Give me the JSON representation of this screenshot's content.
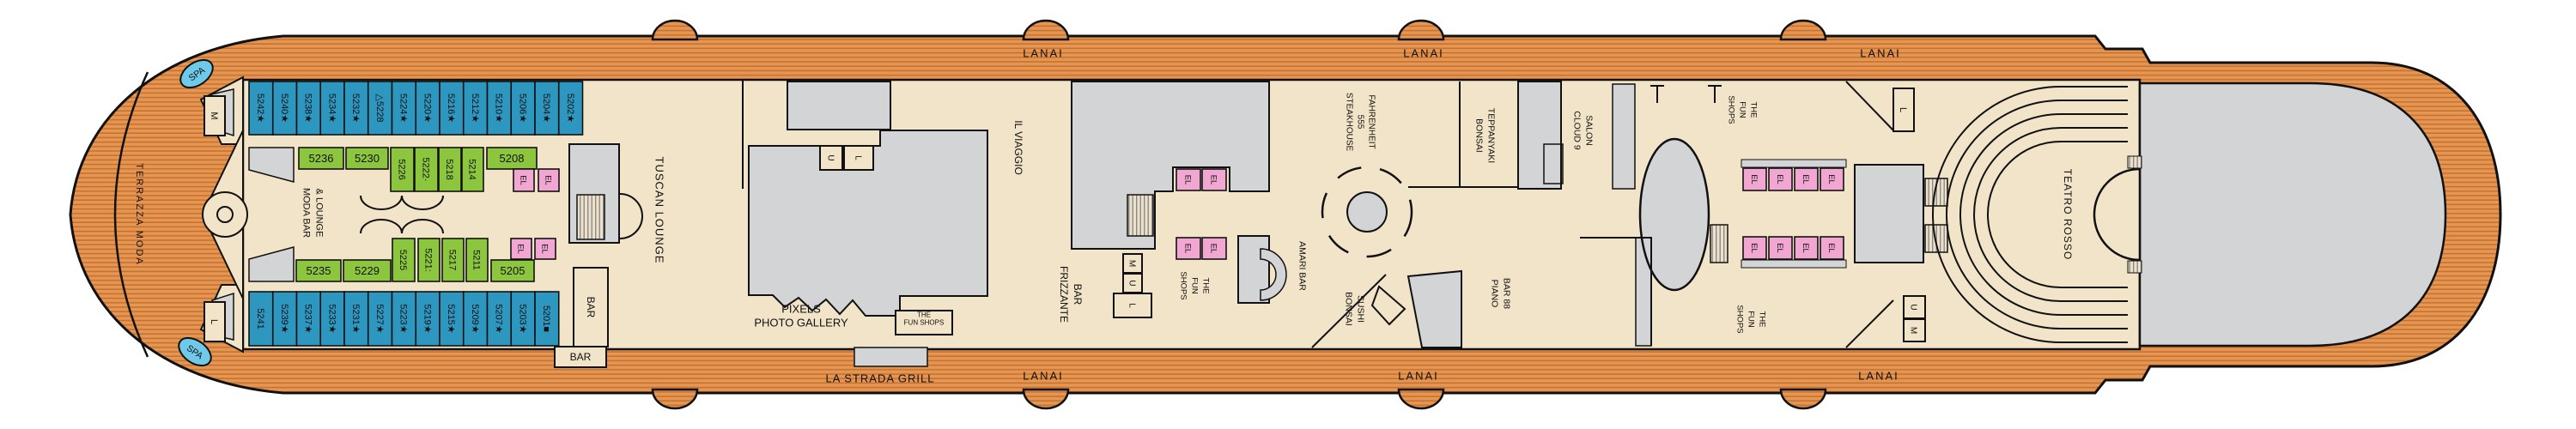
{
  "ship": {
    "labels": {
      "lanai": "LANAI",
      "la_strada_grill": "LA STRADA GRILL",
      "bar": "BAR",
      "spa": "SPA",
      "el": "EL",
      "m": "M",
      "u": "U",
      "l": "L"
    },
    "venues": {
      "terrazza_moda": "TERRAZZA MODA",
      "moda_bar_lounge": [
        "MODA BAR",
        "& LOUNGE"
      ],
      "tuscan_lounge": "TUSCAN LOUNGE",
      "pixels_photo_gallery": [
        "PIXELS",
        "PHOTO GALLERY"
      ],
      "the_fun_shops_gallery": [
        "THE",
        "FUN SHOPS"
      ],
      "il_viaggio": "IL VIAGGIO",
      "frizzante_bar": [
        "FRIZZANTE",
        "BAR"
      ],
      "the_fun_shops_midship": [
        "THE",
        "FUN",
        "SHOPS"
      ],
      "fahrenheit_555_steakhouse": [
        "FAHRENHEIT",
        "555",
        "STEAKHOUSE"
      ],
      "bonsai_teppanyaki": [
        "BONSAI",
        "TEPPANYAKI"
      ],
      "amari_bar": "AMARI BAR",
      "bonsai_sushi": [
        "BONSAI",
        "SUSHI"
      ],
      "piano_bar_88": [
        "PIANO",
        "BAR 88"
      ],
      "cloud_9_salon": [
        "CLOUD 9",
        "SALON"
      ],
      "the_fun_shops_aft_top": [
        "THE",
        "FUN",
        "SHOPS"
      ],
      "the_fun_shops_aft_bottom": [
        "THE",
        "FUN",
        "SHOPS"
      ],
      "teatro_rosso": "TEATRO ROSSO"
    },
    "cabins": {
      "balcony_top_row": [
        "5242★",
        "5240★",
        "5238★",
        "5234★",
        "5232★",
        "△5228",
        "5224★",
        "5220★",
        "5216★",
        "5212★",
        "5210★",
        "5206★",
        "5204★",
        "5202★"
      ],
      "interior_top_row": [
        "5236",
        "5230",
        "5226",
        "5222·",
        "5218",
        "5214",
        "5208"
      ],
      "interior_bottom_row": [
        "5235",
        "5229",
        "5225",
        "5221:",
        "5217",
        "5211",
        "5205"
      ],
      "balcony_bottom_row": [
        "5241",
        "5239★",
        "5237★",
        "5233★",
        "5231★",
        "5227★",
        "5223★",
        "5219★",
        "5215★",
        "5209★",
        "5207★",
        "5203★",
        "5201■"
      ]
    },
    "colors": {
      "wood": "#E8954F",
      "wood_stripe": "#C07438",
      "interior": "#F2E4C8",
      "balcony_cabin": "#2E97C0",
      "interior_cabin": "#8CC63E",
      "elevator": "#F2A7D2",
      "service": "#D3D4D6",
      "spa": "#6FC9E9"
    }
  }
}
